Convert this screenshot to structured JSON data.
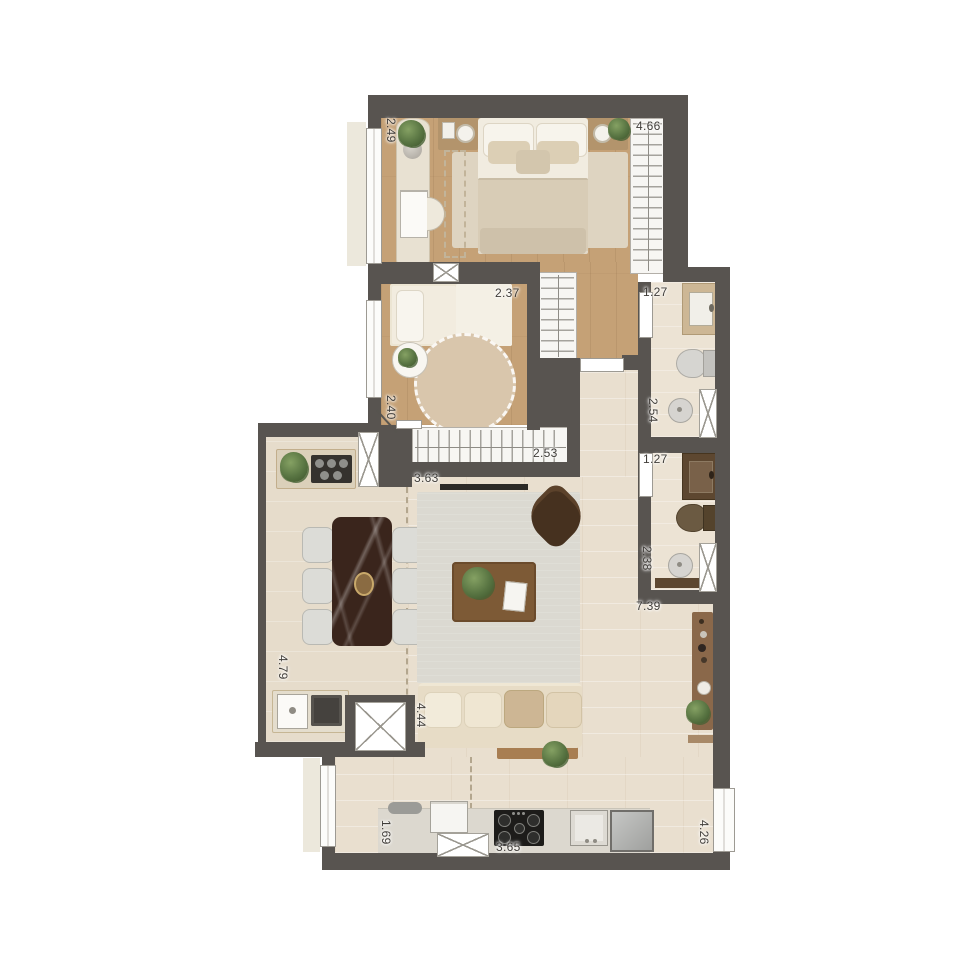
{
  "dims": {
    "master_width": "2.49",
    "master_closet_length": "4.66",
    "bedroom2_width": "2.37",
    "bath1_width": "1.27",
    "bedroom2_depth": "2.40",
    "bath1_depth": "2.54",
    "hall_closet_length": "2.53",
    "bath2_width": "1.27",
    "living_width": "3.63",
    "bath2_depth": "2.38",
    "living_length": "7.39",
    "balcony_depth": "4.79",
    "living_sofa_wall": "4.44",
    "kitchen_left_depth": "1.69",
    "kitchen_counter_length": "3.65",
    "kitchen_right_depth": "4.26"
  },
  "palette": {
    "wall": "#585450",
    "wood_floor": "#c5a176",
    "stone_floor": "#e9dfcf",
    "closet_white": "#f7f6f3",
    "marble_table": "#3a251c",
    "sofa_cream": "#e7dcc6",
    "armchair_brown": "#46311f",
    "plant_green": "#587442",
    "label_text": "#403d39"
  }
}
